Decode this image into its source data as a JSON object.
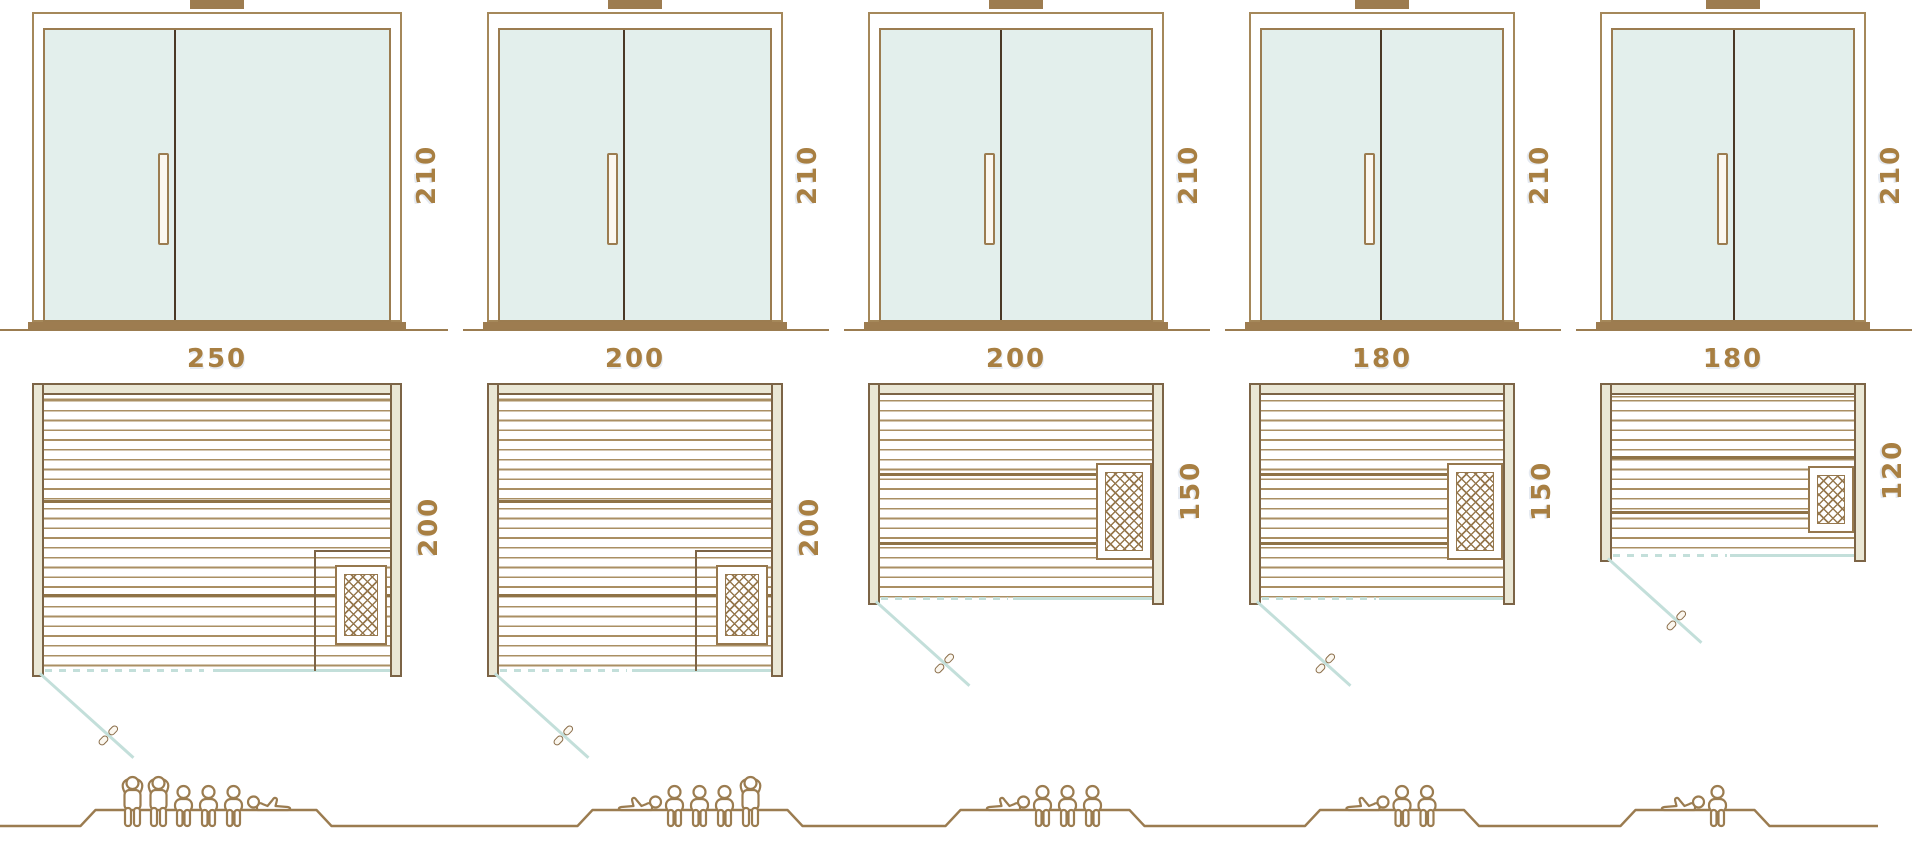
{
  "diagram_title": "Sauna cabin size comparison",
  "colors": {
    "frame": "#a5885a",
    "frame_dark": "#9b7c50",
    "door_divider": "#4a3826",
    "glass": "#e3efec",
    "wall_fill": "#eae7d5",
    "wall_border": "#7c6446",
    "plank": "#aa8f63",
    "bench": "#8f7347",
    "heater": "#96784e",
    "swing": "#c3dfda",
    "label": "#a87f42",
    "people": "#9b7c50"
  },
  "units": [
    {
      "name": "sauna-250x200",
      "width_label": "250",
      "depth_label": "200",
      "height_label": "210",
      "width_cm": 250,
      "depth_cm": 200,
      "height_cm": 210,
      "heater_position": "bottom-right-corner",
      "capacity": {
        "total": 6,
        "standing": 2,
        "sitting": 3,
        "lying": 1,
        "arrangement": [
          "standing",
          "standing",
          "sitting",
          "sitting",
          "sitting",
          "lying-right"
        ]
      }
    },
    {
      "name": "sauna-200x200",
      "width_label": "200",
      "depth_label": "200",
      "height_label": "210",
      "width_cm": 200,
      "depth_cm": 200,
      "height_cm": 210,
      "heater_position": "bottom-right-corner",
      "capacity": {
        "total": 5,
        "standing": 1,
        "sitting": 3,
        "lying": 1,
        "arrangement": [
          "lying-left",
          "sitting",
          "sitting",
          "sitting",
          "standing"
        ]
      }
    },
    {
      "name": "sauna-200x150",
      "width_label": "200",
      "depth_label": "150",
      "height_label": "210",
      "width_cm": 200,
      "depth_cm": 150,
      "height_cm": 210,
      "heater_position": "right-wall-middle",
      "capacity": {
        "total": 4,
        "standing": 0,
        "sitting": 3,
        "lying": 1,
        "arrangement": [
          "lying-left",
          "sitting",
          "sitting",
          "sitting"
        ]
      }
    },
    {
      "name": "sauna-180x150",
      "width_label": "180",
      "depth_label": "150",
      "height_label": "210",
      "width_cm": 180,
      "depth_cm": 150,
      "height_cm": 210,
      "heater_position": "right-wall-middle",
      "capacity": {
        "total": 3,
        "standing": 0,
        "sitting": 2,
        "lying": 1,
        "arrangement": [
          "lying-left",
          "sitting",
          "sitting"
        ]
      }
    },
    {
      "name": "sauna-180x120",
      "width_label": "180",
      "depth_label": "120",
      "height_label": "210",
      "width_cm": 180,
      "depth_cm": 120,
      "height_cm": 210,
      "heater_position": "right-wall-lower",
      "capacity": {
        "total": 2,
        "standing": 0,
        "sitting": 1,
        "lying": 1,
        "arrangement": [
          "lying-left",
          "sitting"
        ]
      }
    }
  ]
}
